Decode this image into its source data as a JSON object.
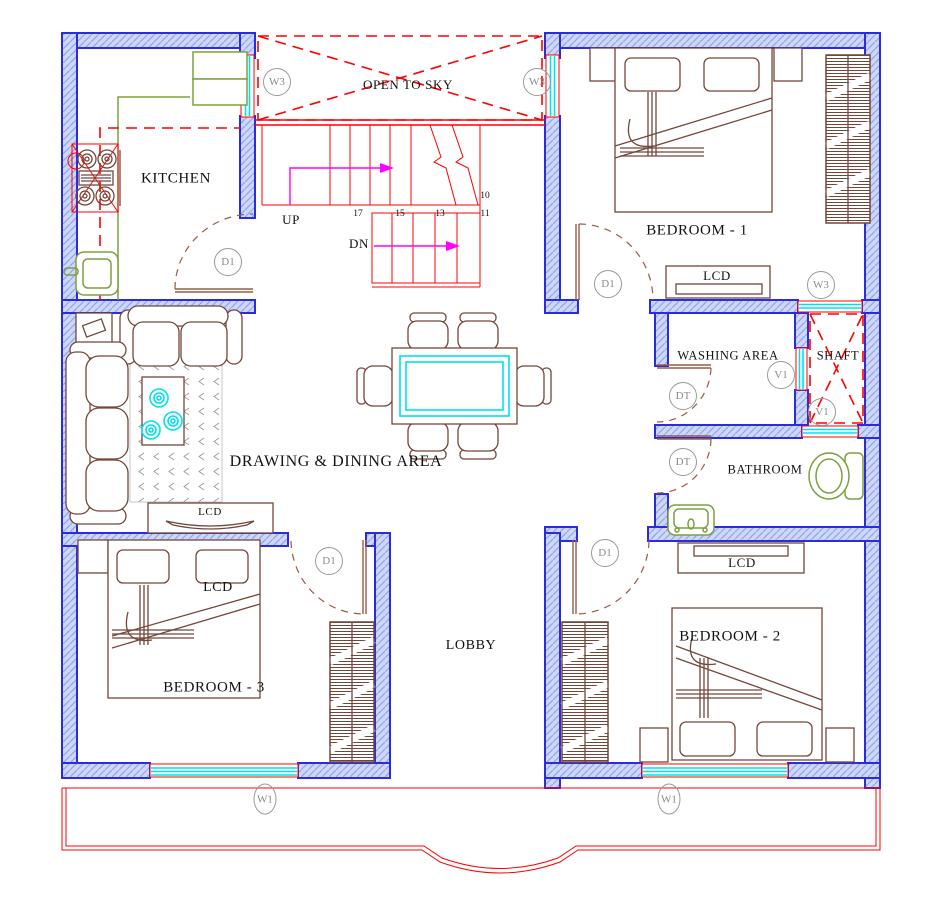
{
  "rooms": {
    "kitchen": "KITCHEN",
    "open_to_sky": "OPEN TO SKY",
    "bedroom1": "BEDROOM - 1",
    "washing_area": "WASHING AREA",
    "shaft": "SHAFT",
    "bathroom": "BATHROOM",
    "drawing_dining": "DRAWING & DINING AREA",
    "lobby": "LOBBY",
    "bedroom3": "BEDROOM - 3",
    "bedroom2": "BEDROOM - 2"
  },
  "labels": {
    "lcd": "LCD"
  },
  "markers": {
    "window_w3": "W3",
    "door_d1": "D1",
    "door_dt": "DT",
    "vent_v1": "V1",
    "window_w1": "W1"
  },
  "stairs": {
    "up": "UP",
    "down": "DN",
    "risers": [
      "17",
      "15",
      "13",
      "11",
      "10"
    ]
  },
  "colors": {
    "wall_blue": "#2b2bdf",
    "wall_fill": "#cdd7f8",
    "wall_hatch": "#93a4ec",
    "line_red": "#ff0000",
    "arrow_magenta": "#ff00ff",
    "glass_cyan": "#00e0f0",
    "furniture_brown": "#74463a",
    "fixture_olive": "#7fa03f",
    "marker_gray": "#8a8a8a"
  }
}
